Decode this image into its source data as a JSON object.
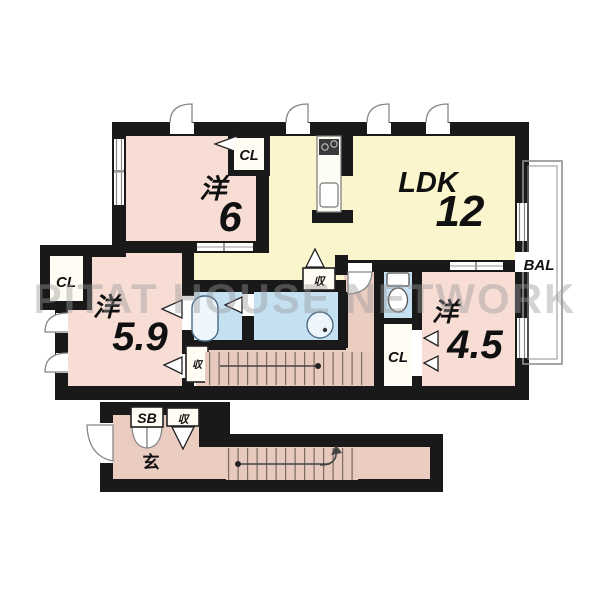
{
  "watermark": "PITAT HOUSE NETWORK",
  "colors": {
    "wall": "#191919",
    "bedroom_pink": "#f8ddd5",
    "ldk_cream": "#faf5cd",
    "wet_area_blue": "#c5e0f1",
    "hall_pink": "#eaccc1"
  },
  "rooms": {
    "bedroom6": {
      "kanji": "洋",
      "size": "6"
    },
    "ldk": {
      "name": "LDK",
      "size": "12"
    },
    "bedroom59": {
      "kanji": "洋",
      "size": "5.9"
    },
    "bedroom45": {
      "kanji": "洋",
      "size": "4.5"
    },
    "balcony": {
      "label": "BAL"
    },
    "entrance": {
      "label": "玄"
    }
  },
  "fixtures": {
    "closet": "CL",
    "storage": "収",
    "shoe_box": "SB"
  }
}
